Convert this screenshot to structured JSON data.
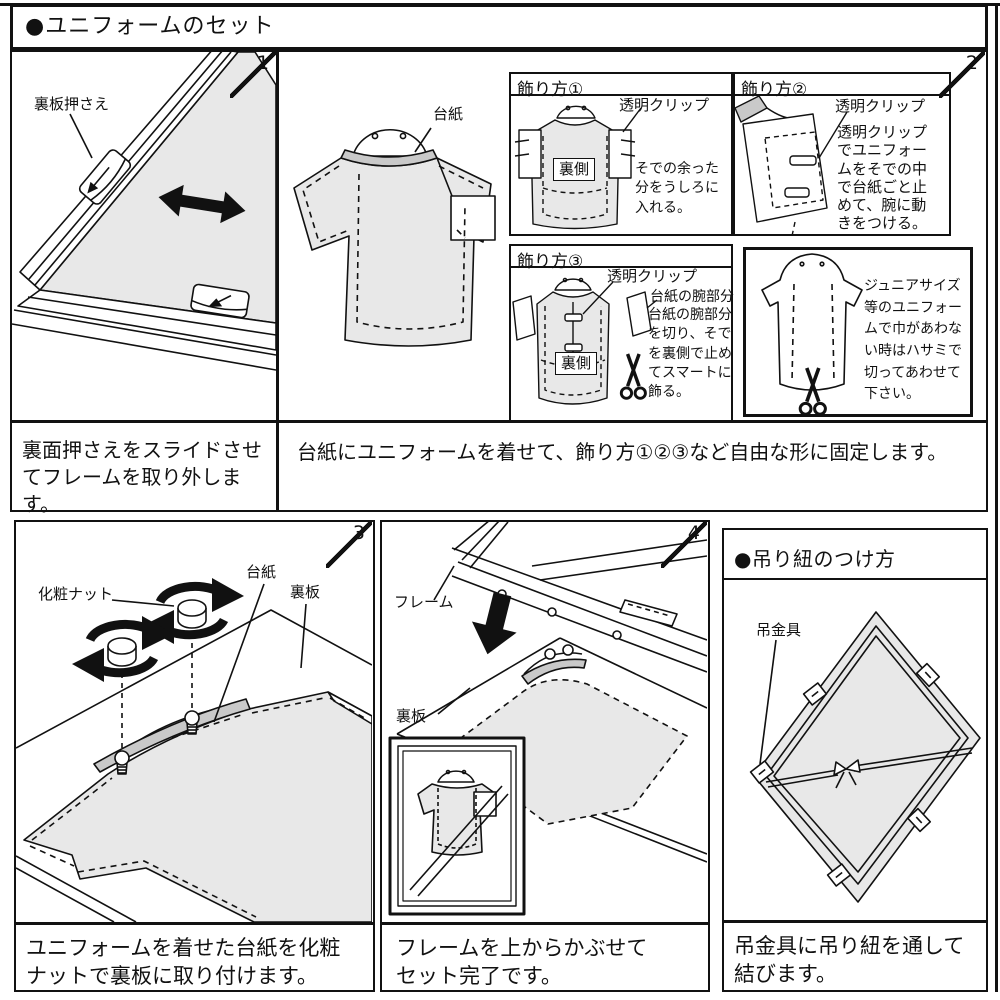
{
  "title": "●ユニフォームのセット",
  "colors": {
    "ink": "#111111",
    "paper": "#ffffff",
    "gray_fill": "#e8e8e8",
    "band_fill": "#c9c9c9"
  },
  "panel1": {
    "number": "1",
    "part_label": "裏板押さえ",
    "caption": "裏面押さえをスライドさせてフレームを取り外します。"
  },
  "panel2": {
    "number": "2",
    "mount_label": "台紙",
    "caption": "台紙にユニフォームを着せて、飾り方①②③など自由な形に固定します。",
    "deco1": {
      "header": "飾り方①",
      "clip_label": "透明クリップ",
      "back_label": "裏側",
      "text": "そでの余った分をうしろに入れる。"
    },
    "deco2": {
      "header": "飾り方②",
      "clip_label": "透明クリップ",
      "text": "透明クリップでユニフォームをそでの中で台紙ごと止めて、腕に動きをつける。"
    },
    "deco3": {
      "header": "飾り方③",
      "clip_label": "透明クリップ",
      "arm_label": "台紙の腕部分",
      "back_label": "裏側",
      "text": "台紙の腕部分を切り、そでを裏側で止めてスマートに飾る。"
    },
    "junior": {
      "text": "ジュニアサイズ等のユニフォームで巾があわない時はハサミで切ってあわせて下さい。"
    }
  },
  "panel3": {
    "number": "3",
    "nut_label": "化粧ナット",
    "mount_label": "台紙",
    "board_label": "裏板",
    "caption": "ユニフォームを着せた台紙を化粧ナットで裏板に取り付けます。"
  },
  "panel4": {
    "number": "4",
    "frame_label": "フレーム",
    "board_label": "裏板",
    "caption": "フレームを上からかぶせてセット完了です。"
  },
  "hanging": {
    "header": "●吊り紐のつけ方",
    "hardware_label": "吊金具",
    "caption": "吊金具に吊り紐を通して結びます。"
  }
}
